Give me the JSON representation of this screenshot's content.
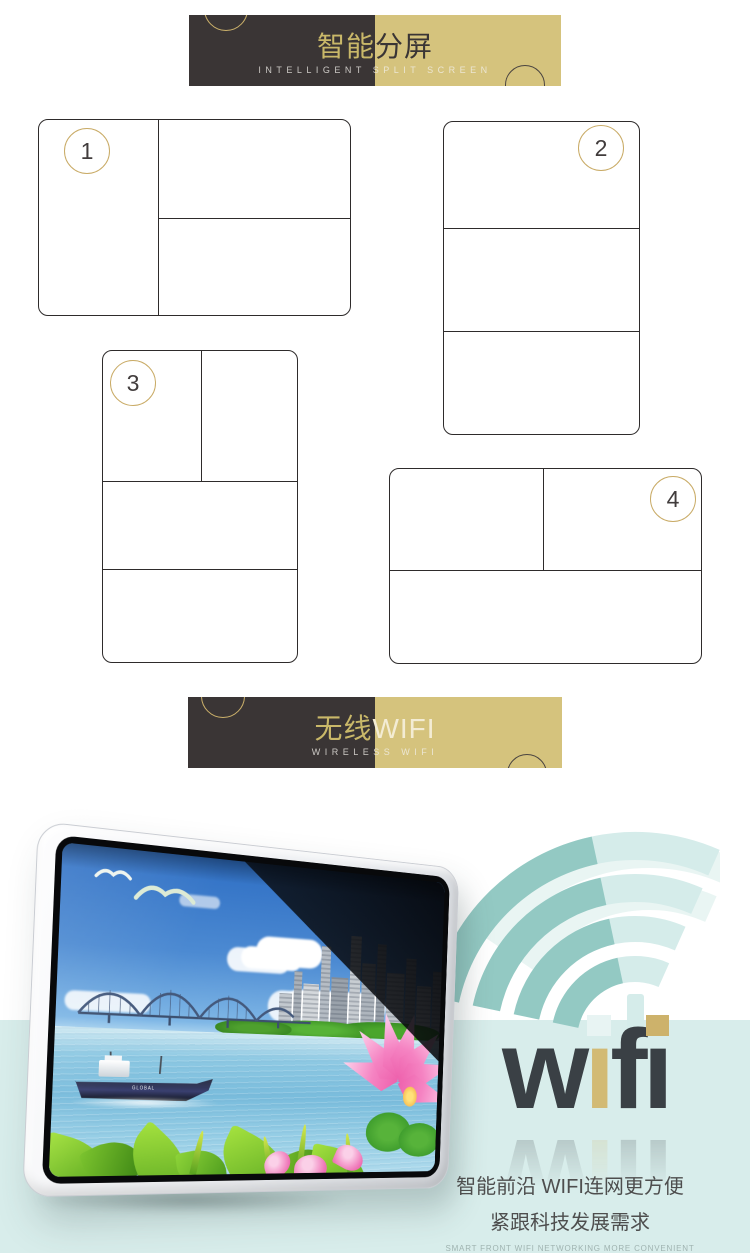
{
  "banner_split": {
    "title_left": "智能",
    "title_right": "分屏",
    "subtitle": "INTELLIGENT SPLIT SCREEN"
  },
  "banner_wifi": {
    "title_left": "无线",
    "title_right": "WIFI",
    "subtitle": "WIRELESS WIFI"
  },
  "diagrams": [
    {
      "number": "1"
    },
    {
      "number": "2"
    },
    {
      "number": "3"
    },
    {
      "number": "4"
    }
  ],
  "wifi_art": {
    "letters": [
      "w",
      "ı",
      "f",
      "ı"
    ]
  },
  "screen": {
    "ship_label": "GLOBAL"
  },
  "caption": {
    "line1": "智能前沿 WIFI连网更方便",
    "line2": "紧跟科技发展需求",
    "en1": "SMART FRONT WIFI NETWORKING MORE CONVENIENT",
    "en2": "FOLLOWING THE DEVELOPMENT OF SCIENCE AND TECHNOLOGY REQUIREMENTS"
  },
  "colors": {
    "banner_dark": "#3a3535",
    "banner_gold": "#d5c37d",
    "gold_ring": "#c9ab66",
    "mint_background": "#d8edeb",
    "beam_teal": "#93c9c3",
    "beam_light": "#d9edeb",
    "wifi_dark": "#3a4045",
    "wifi_gold": "#d2ba74"
  }
}
